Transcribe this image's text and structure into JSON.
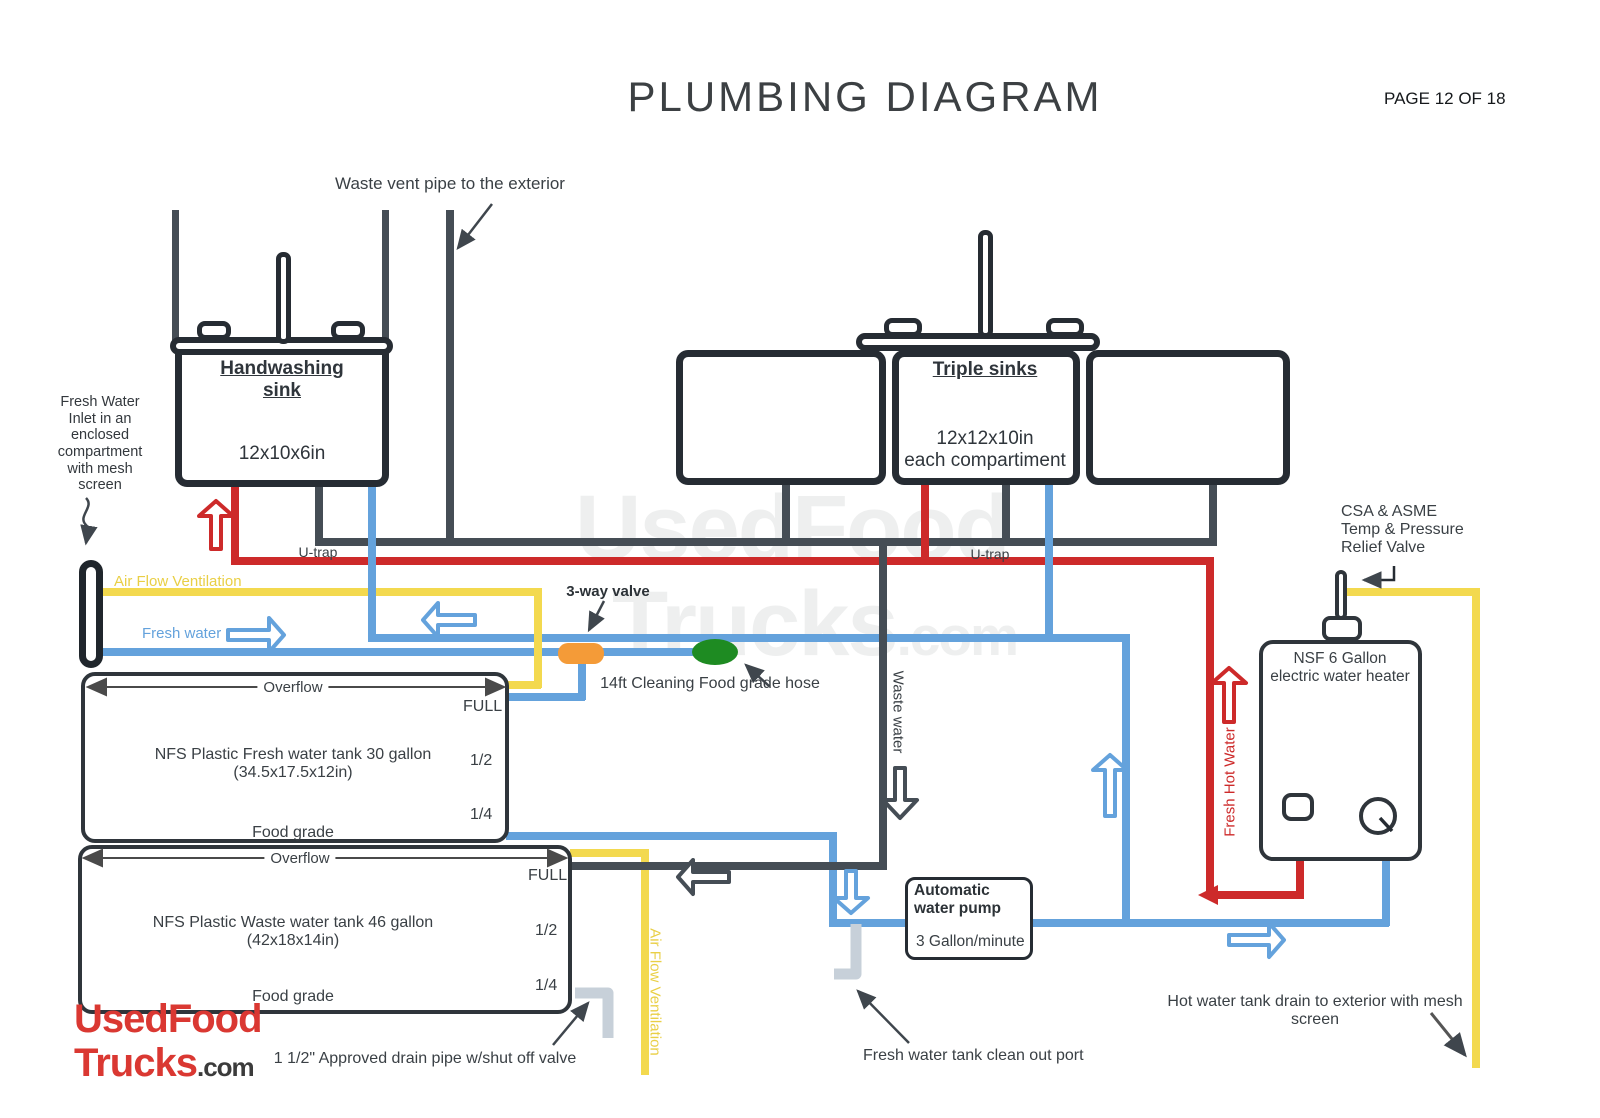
{
  "header": {
    "title": "PLUMBING DIAGRAM",
    "page": "PAGE 12 OF 18"
  },
  "watermark": {
    "word1": "UsedFood",
    "word2": "Trucks",
    "word3": ".com"
  },
  "logo": {
    "word1": "UsedFood",
    "word2": "Trucks",
    "word3": ".com"
  },
  "annotations": {
    "waste_vent": "Waste vent pipe to the exterior",
    "inlet_lines": [
      "Fresh Water",
      "Inlet in an",
      "enclosed",
      "compartment",
      "with mesh",
      "screen"
    ],
    "air_flow": "Air Flow Ventilation",
    "air_flow_vertical": "Air Flow Ventilation",
    "fresh_water": "Fresh water",
    "u_trap_left": "U-trap",
    "u_trap_right": "U-trap",
    "three_way_valve": "3-way valve",
    "cleaning_hose": "14ft Cleaning Food grade hose",
    "waste_water": "Waste water",
    "fresh_hot_water": "Fresh Hot Water",
    "relief_lines": [
      "CSA & ASME",
      "Temp & Pressure",
      "Relief Valve"
    ],
    "hot_drain_line1": "Hot water tank drain to exterior with mesh",
    "hot_drain_line2": "screen",
    "clean_out": "Fresh water tank clean out port",
    "drain_pipe": "1 1/2\" Approved drain pipe w/shut off valve"
  },
  "sinks": {
    "handwashing": {
      "title_line1": "Handwashing",
      "title_line2": "sink",
      "dims": "12x10x6in"
    },
    "triple": {
      "title": "Triple sinks",
      "dims_line1": "12x12x10in",
      "dims_line2": "each compartiment"
    }
  },
  "tanks": {
    "fresh": {
      "overflow": "Overflow",
      "full": "FULL",
      "half": "1/2",
      "quarter": "1/4",
      "name": "NFS Plastic Fresh water tank 30 gallon",
      "dims": "(34.5x17.5x12in)",
      "grade": "Food grade"
    },
    "waste": {
      "overflow": "Overflow",
      "full": "FULL",
      "half": "1/2",
      "quarter": "1/4",
      "name": "NFS Plastic Waste water tank 46 gallon",
      "dims": "(42x18x14in)",
      "grade": "Food grade"
    }
  },
  "heater": {
    "line1": "NSF 6 Gallon",
    "line2": "electric water heater"
  },
  "pump": {
    "line1": "Automatic",
    "line2": "water pump",
    "rate": "3 Gallon/minute"
  },
  "colors": {
    "fresh": "#64a2dc",
    "hot": "#cd2a2a",
    "air": "#f3d94f",
    "waste": "#454d55",
    "valve": "#f49b38",
    "hose": "#1e8b22",
    "logo_red": "#da3832",
    "lightpipe": "#c7d0d9"
  }
}
